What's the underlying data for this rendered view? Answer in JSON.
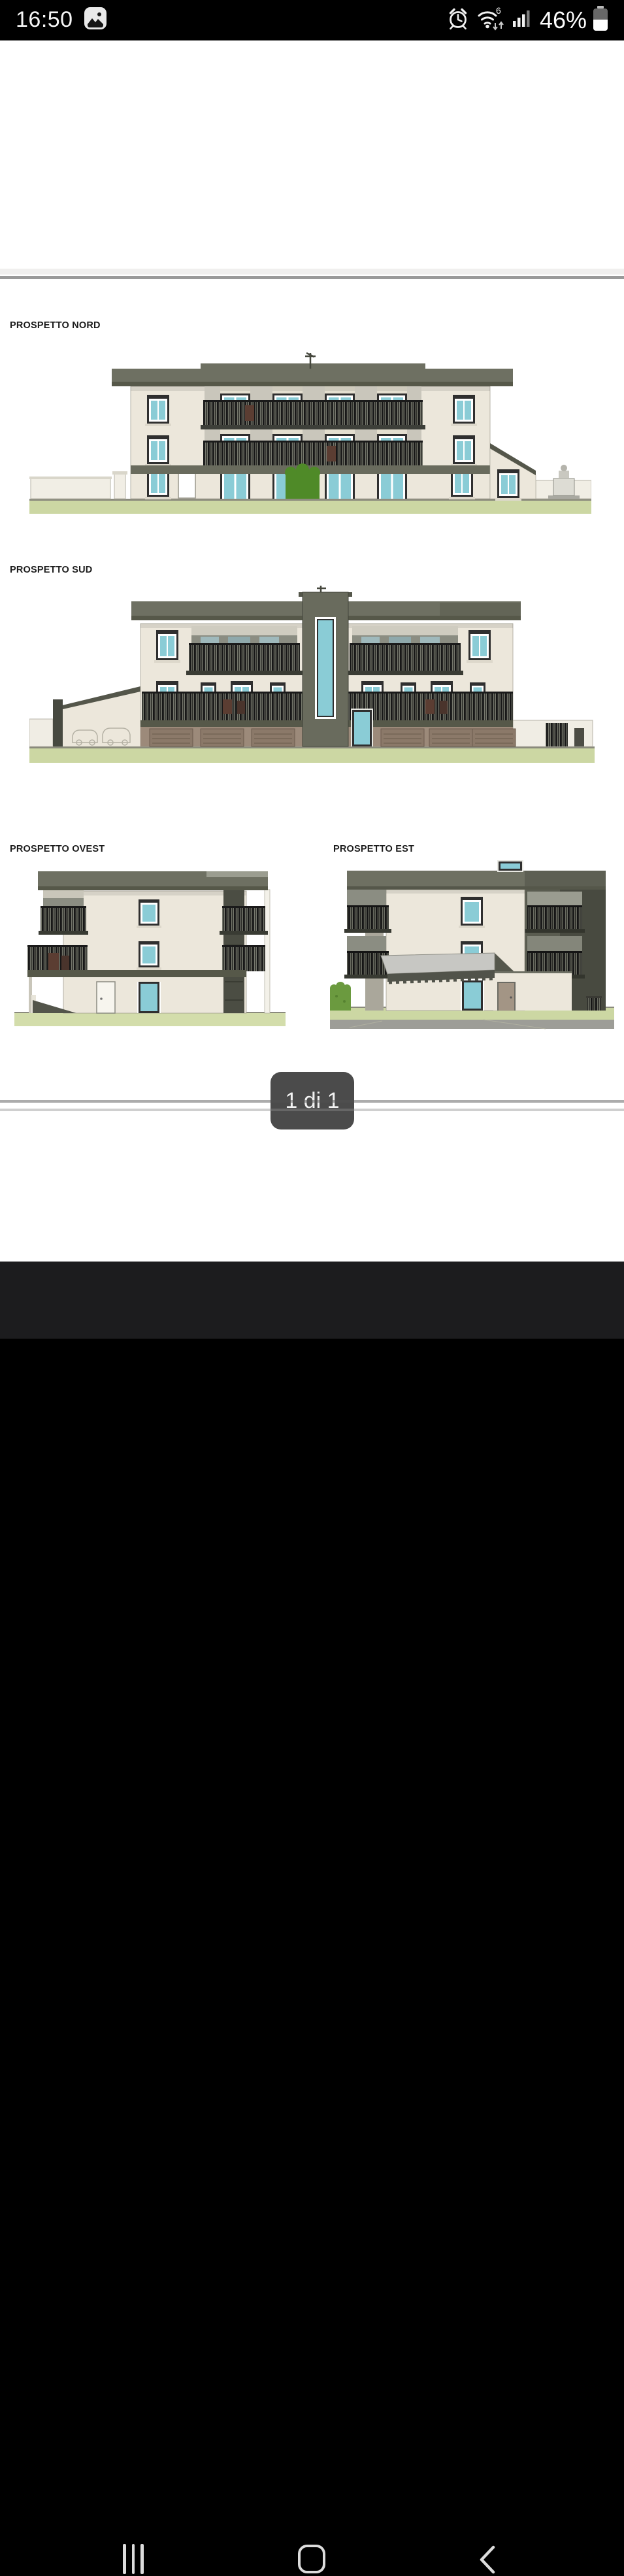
{
  "status_bar": {
    "time": "16:50",
    "wifi_generation": "6",
    "battery_percent": "46%",
    "icons": [
      "gallery-icon",
      "alarm-icon",
      "wifi-icon",
      "signal-strength-icon",
      "battery-icon"
    ]
  },
  "viewer": {
    "page_indicator": "1 di 1"
  },
  "document": {
    "drawings": {
      "north": {
        "label": "PROSPETTO NORD"
      },
      "south": {
        "label": "PROSPETTO SUD"
      },
      "west": {
        "label": "PROSPETTO OVEST"
      },
      "east": {
        "label": "PROSPETTO EST"
      }
    }
  },
  "nav_bar": {
    "icons": [
      "recents-icon",
      "home-icon",
      "back-icon"
    ]
  },
  "palette": {
    "roof": "#6e7062",
    "roof-dark": "#565849",
    "wall": "#ece7db",
    "glass": "#8accd6",
    "frame": "#2f2f2f",
    "ground": "#ccd7a3",
    "ground-west": "#d3ddab",
    "road": "#9d9d97",
    "garage-wall": "#9c8a7a",
    "garage-door": "#8b7969",
    "tower": "#696b5d",
    "recess": "#8b8d82",
    "dark-side": "#5a5c50",
    "bush": "#4f8a28",
    "hedge": "#6b9a3f",
    "canopy": "#c7c7c3",
    "badge-bg": "#4b4b4b",
    "navbar-bg": "#1c1c1e"
  }
}
